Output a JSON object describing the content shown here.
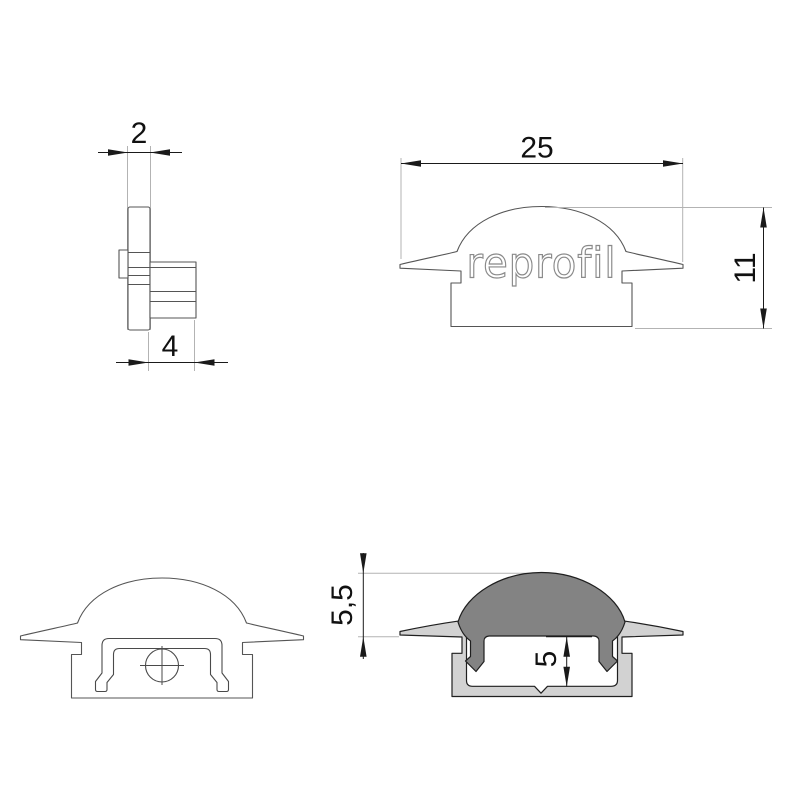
{
  "drawing": {
    "brand_label": "reprofil",
    "colors": {
      "background": "#ffffff",
      "outline": "#555555",
      "section_outline": "#1f1f1f",
      "dimension_text": "#1a1a1a",
      "extension_line": "#b3b3b3",
      "aluminum_fill": "#d2d2d2",
      "cover_fill": "#838383",
      "brand_stroke": "#8a8a8a"
    },
    "views": {
      "side_view": {
        "flange_thickness_mm": "2",
        "plug_depth_mm": "4"
      },
      "front_view": {
        "overall_width_mm": "25",
        "overall_height_mm": "11"
      },
      "section_view": {
        "cover_height_mm": "5,5",
        "inner_depth_mm": "5"
      }
    }
  }
}
